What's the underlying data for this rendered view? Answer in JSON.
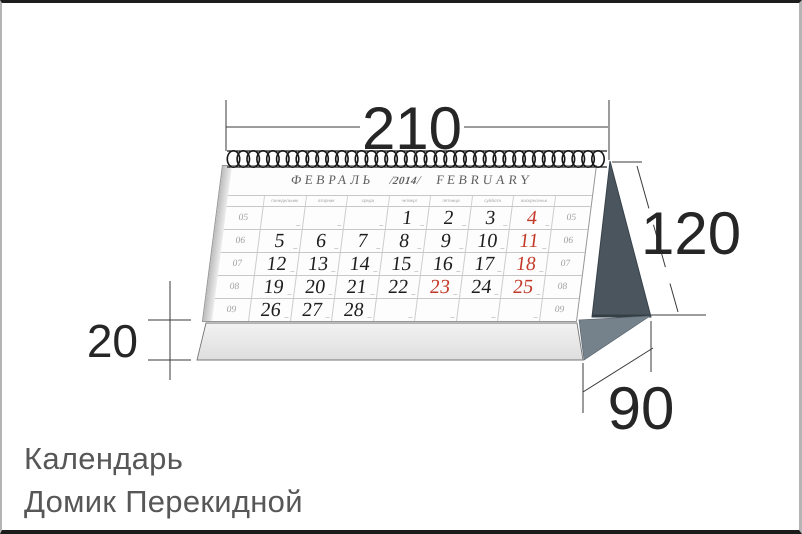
{
  "product": {
    "title_line1": "Календарь",
    "title_line2": "Домик Перекидной"
  },
  "dimensions": {
    "width": "210",
    "height": "120",
    "base_height": "20",
    "depth": "90"
  },
  "calendar": {
    "month_ru": "ФЕВРАЛЬ",
    "slash": "/",
    "year": "2014",
    "month_en": "FEBRUARY",
    "weekday_headers": [
      "понедельник",
      "вторник",
      "среда",
      "четверг",
      "пятница",
      "суббота",
      "воскресенье"
    ],
    "weeks": [
      {
        "num": "05",
        "days": [
          {
            "d": ""
          },
          {
            "d": ""
          },
          {
            "d": ""
          },
          {
            "d": "1"
          },
          {
            "d": "2"
          },
          {
            "d": "3"
          },
          {
            "d": "4",
            "red": true
          }
        ]
      },
      {
        "num": "06",
        "days": [
          {
            "d": "5"
          },
          {
            "d": "6"
          },
          {
            "d": "7"
          },
          {
            "d": "8"
          },
          {
            "d": "9"
          },
          {
            "d": "10"
          },
          {
            "d": "11",
            "red": true
          }
        ]
      },
      {
        "num": "07",
        "days": [
          {
            "d": "12"
          },
          {
            "d": "13"
          },
          {
            "d": "14"
          },
          {
            "d": "15"
          },
          {
            "d": "16"
          },
          {
            "d": "17"
          },
          {
            "d": "18",
            "red": true
          }
        ]
      },
      {
        "num": "08",
        "days": [
          {
            "d": "19"
          },
          {
            "d": "20"
          },
          {
            "d": "21"
          },
          {
            "d": "22"
          },
          {
            "d": "23",
            "red": true
          },
          {
            "d": "24"
          },
          {
            "d": "25",
            "red": true
          }
        ]
      },
      {
        "num": "09",
        "days": [
          {
            "d": "26"
          },
          {
            "d": "27"
          },
          {
            "d": "28"
          },
          {
            "d": ""
          },
          {
            "d": ""
          },
          {
            "d": ""
          },
          {
            "d": ""
          }
        ]
      }
    ],
    "red_dates": [
      "4",
      "11",
      "18",
      "23",
      "25"
    ]
  },
  "colors": {
    "red_date": "#c43a2a",
    "gable_side": "#4a555d",
    "base_side": "#75828c",
    "base_front_light": "#efefef",
    "base_front_dark": "#dedede",
    "dimension_line": "#3a3a3a"
  }
}
